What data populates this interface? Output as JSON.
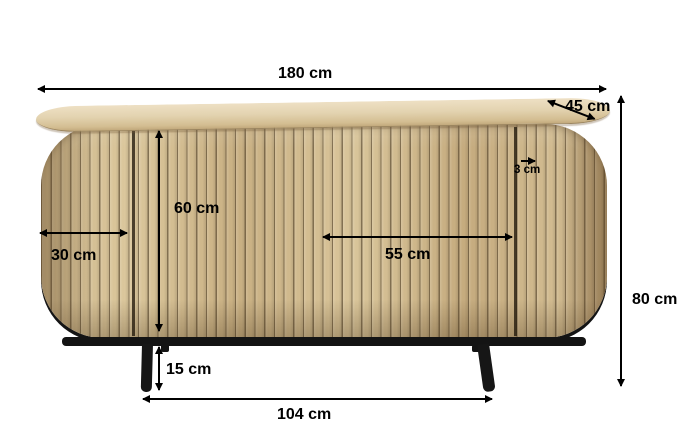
{
  "diagram": {
    "type": "product-dimensions",
    "product": "wooden slatted sideboard with black metal legs",
    "unit": "cm",
    "background_color": "#ffffff",
    "annotation_color": "#000000",
    "colors": {
      "wood_slat_light": "#dbc79c",
      "wood_slat_mid": "#cbb488",
      "wood_slat_gap": "#3d2e1a",
      "wood_top_surface": "#e3d3b0",
      "frame_black": "#141414"
    },
    "measurements": {
      "total_width": {
        "label": "180 cm",
        "value": 180,
        "orientation": "horizontal"
      },
      "depth": {
        "label": "45 cm",
        "value": 45,
        "orientation": "diagonal"
      },
      "total_height": {
        "label": "80 cm",
        "value": 80,
        "orientation": "vertical"
      },
      "door_height": {
        "label": "60 cm",
        "value": 60,
        "orientation": "vertical"
      },
      "side_door_width": {
        "label": "30 cm",
        "value": 30,
        "orientation": "horizontal"
      },
      "middle_section_width": {
        "label": "55 cm",
        "value": 55,
        "orientation": "horizontal"
      },
      "slat_width": {
        "label": "3 cm",
        "value": 3,
        "orientation": "horizontal"
      },
      "leg_height": {
        "label": "15 cm",
        "value": 15,
        "orientation": "vertical"
      },
      "leg_span": {
        "label": "104 cm",
        "value": 104,
        "orientation": "horizontal"
      }
    }
  }
}
